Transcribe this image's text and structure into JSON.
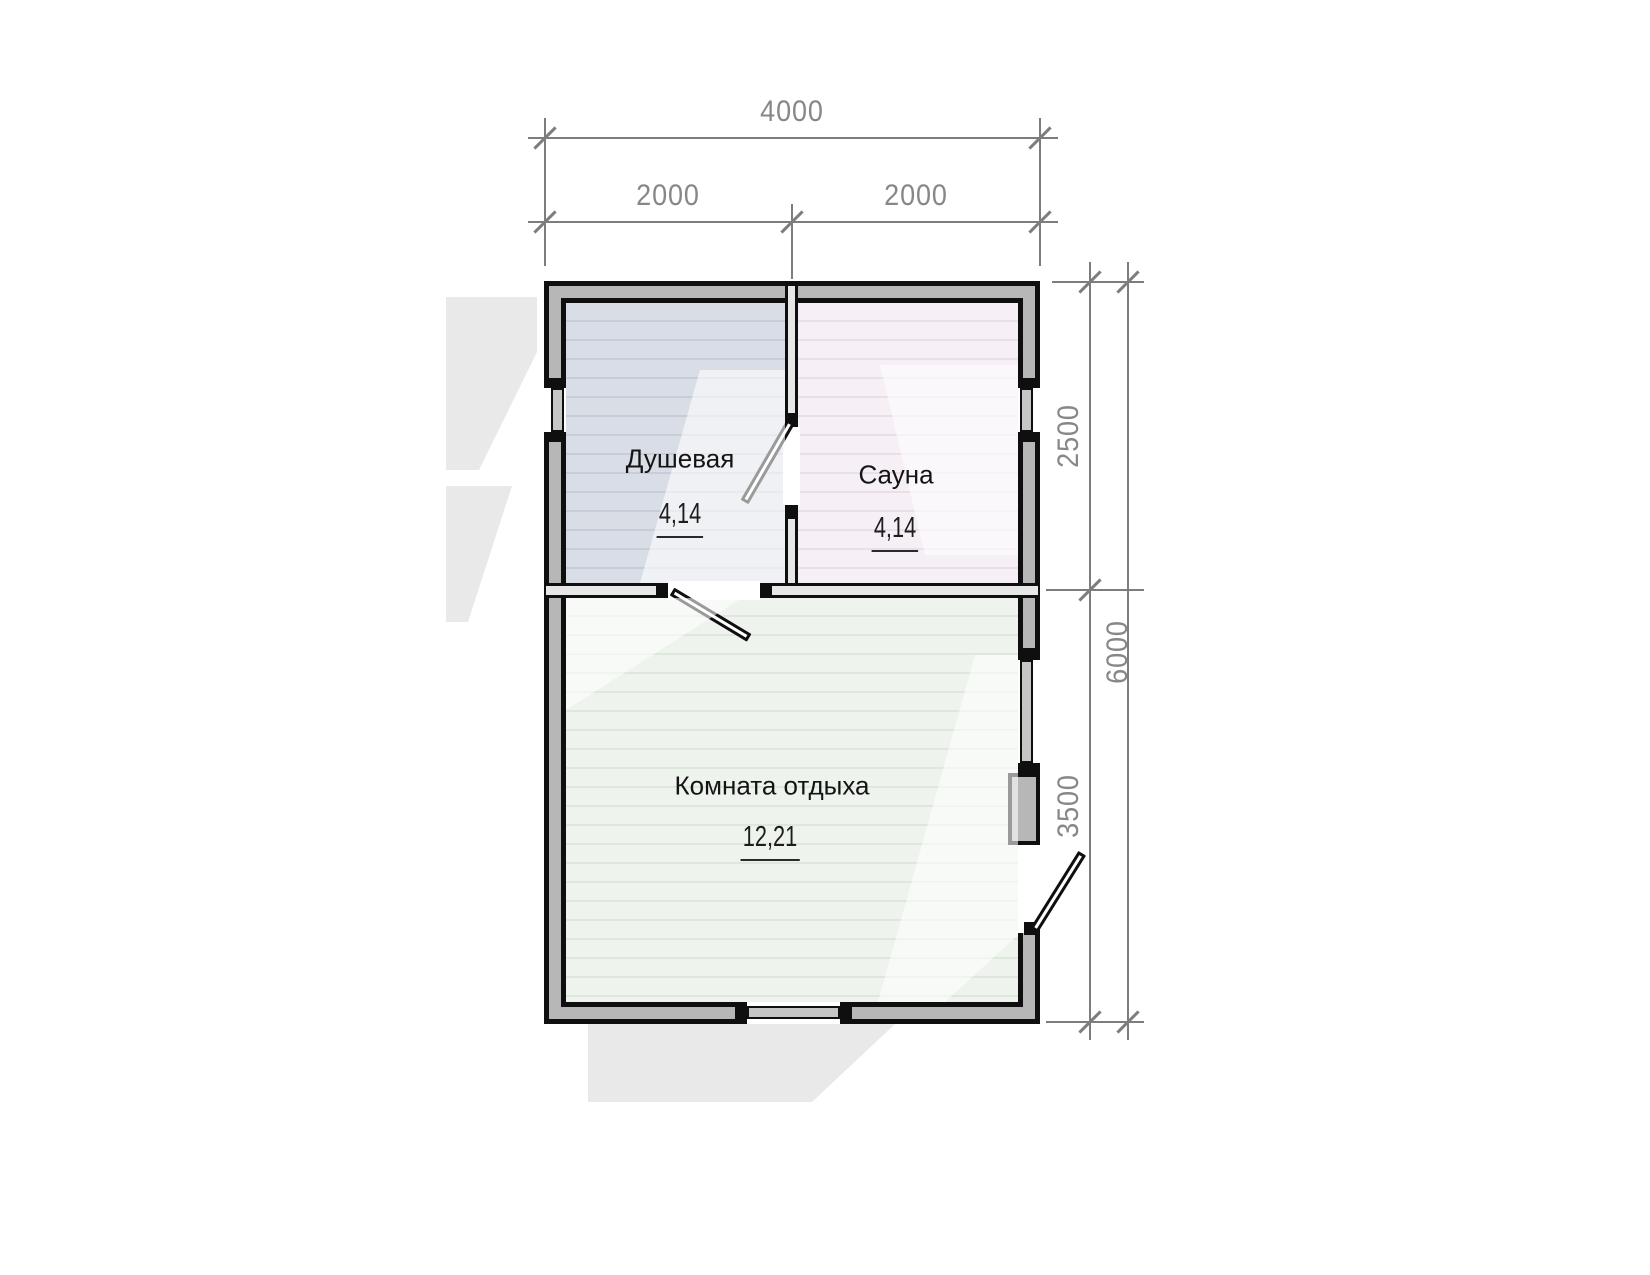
{
  "plan": {
    "type": "floor-plan",
    "rooms": [
      {
        "id": "shower",
        "name": "Душевая",
        "area": "4,14"
      },
      {
        "id": "sauna",
        "name": "Сауна",
        "area": "4,14"
      },
      {
        "id": "lounge",
        "name": "Комната отдыха",
        "area": "12,21"
      }
    ],
    "dimensions": {
      "top_total": "4000",
      "top_left": "2000",
      "top_right": "2000",
      "right_upper": "2500",
      "right_lower": "3500",
      "right_total": "6000"
    },
    "colors": {
      "exterior_wall_fill": "#b7b7b7",
      "partition_fill": "#e7e7e7",
      "outline": "#0f0f0f",
      "floor_shower": "#d9dee6",
      "floor_sauna": "#f6eff5",
      "floor_lounge": "#eef4ed",
      "dimension_gray": "#878787",
      "label_black": "#141414",
      "watermark_gray": "#e9e9e9"
    }
  }
}
